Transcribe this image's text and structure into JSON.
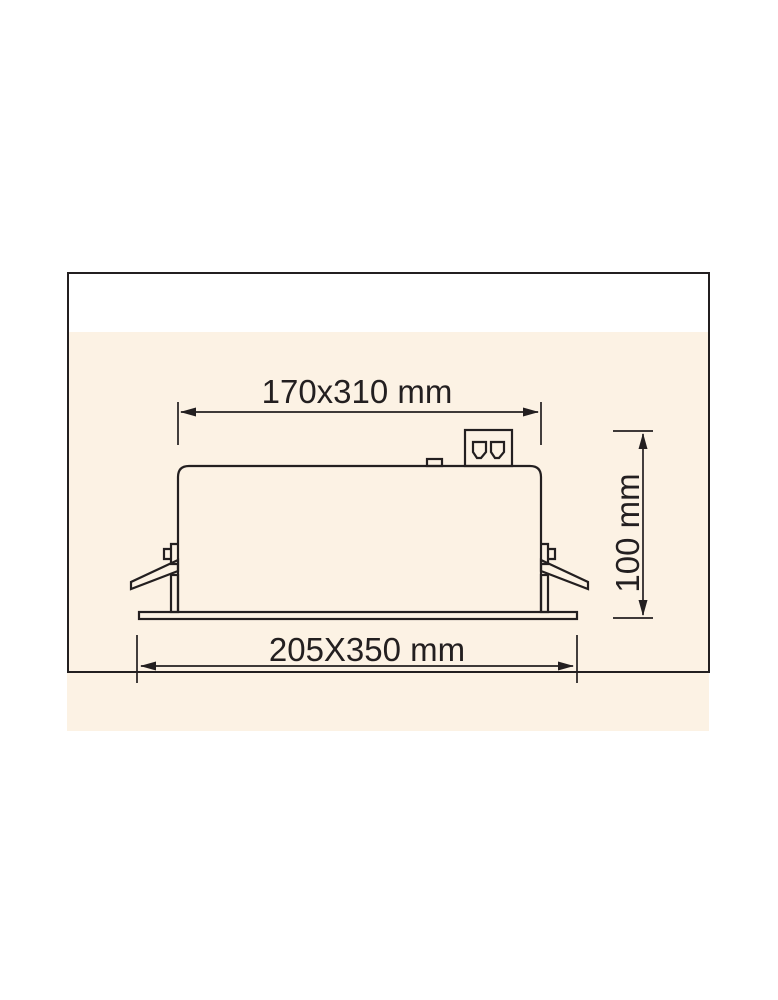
{
  "colors": {
    "page_background": "#ffffff",
    "panel_background": "#fcf2e4",
    "line": "#231f20"
  },
  "dimensions": {
    "top": {
      "label": "170x310 mm"
    },
    "right": {
      "label": "100 mm"
    },
    "bottom": {
      "label": "205X350 mm"
    }
  }
}
